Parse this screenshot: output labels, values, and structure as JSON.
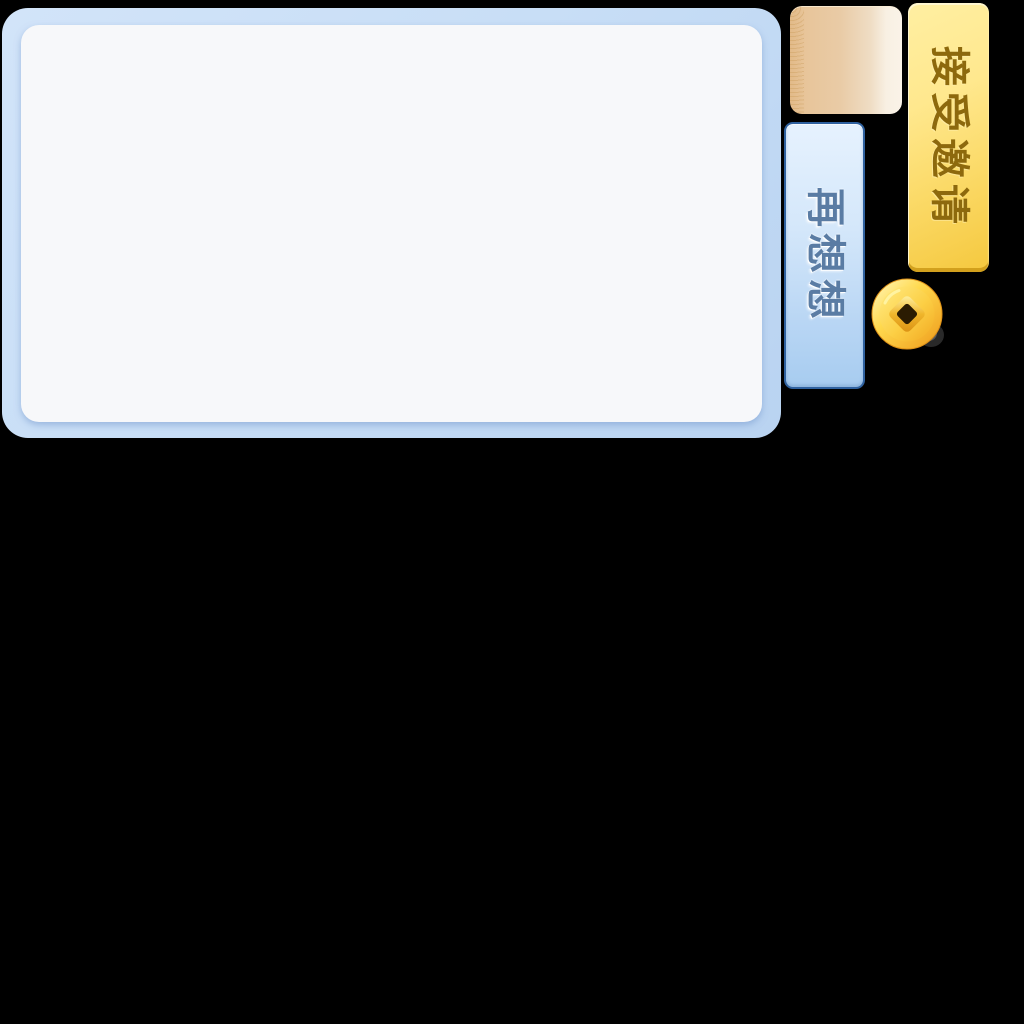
{
  "scene": {
    "background_color": "#000000"
  },
  "dialog": {
    "outer_color": "#c8def6",
    "inner_color": "#f7f8fa"
  },
  "parchment": {
    "color_left": "#e2ba88",
    "color_right": "#faf3e8"
  },
  "buttons": {
    "accept": {
      "label": "接受邀请",
      "bg_top": "#ffefa2",
      "bg_bottom": "#f5c83e",
      "text_color": "#8d690d"
    },
    "decline": {
      "label": "再想想",
      "bg_top": "#e6f2fe",
      "bg_bottom": "#a7ccf0",
      "border_color": "#2f619f",
      "text_color": "#5a7ca4"
    }
  },
  "icons": {
    "coin": {
      "name": "gold-coin-icon",
      "gold_light": "#fff8c0",
      "gold_mid": "#ffd94e",
      "gold_dark": "#ee9a1a",
      "hole_color": "#2b1c02"
    }
  }
}
